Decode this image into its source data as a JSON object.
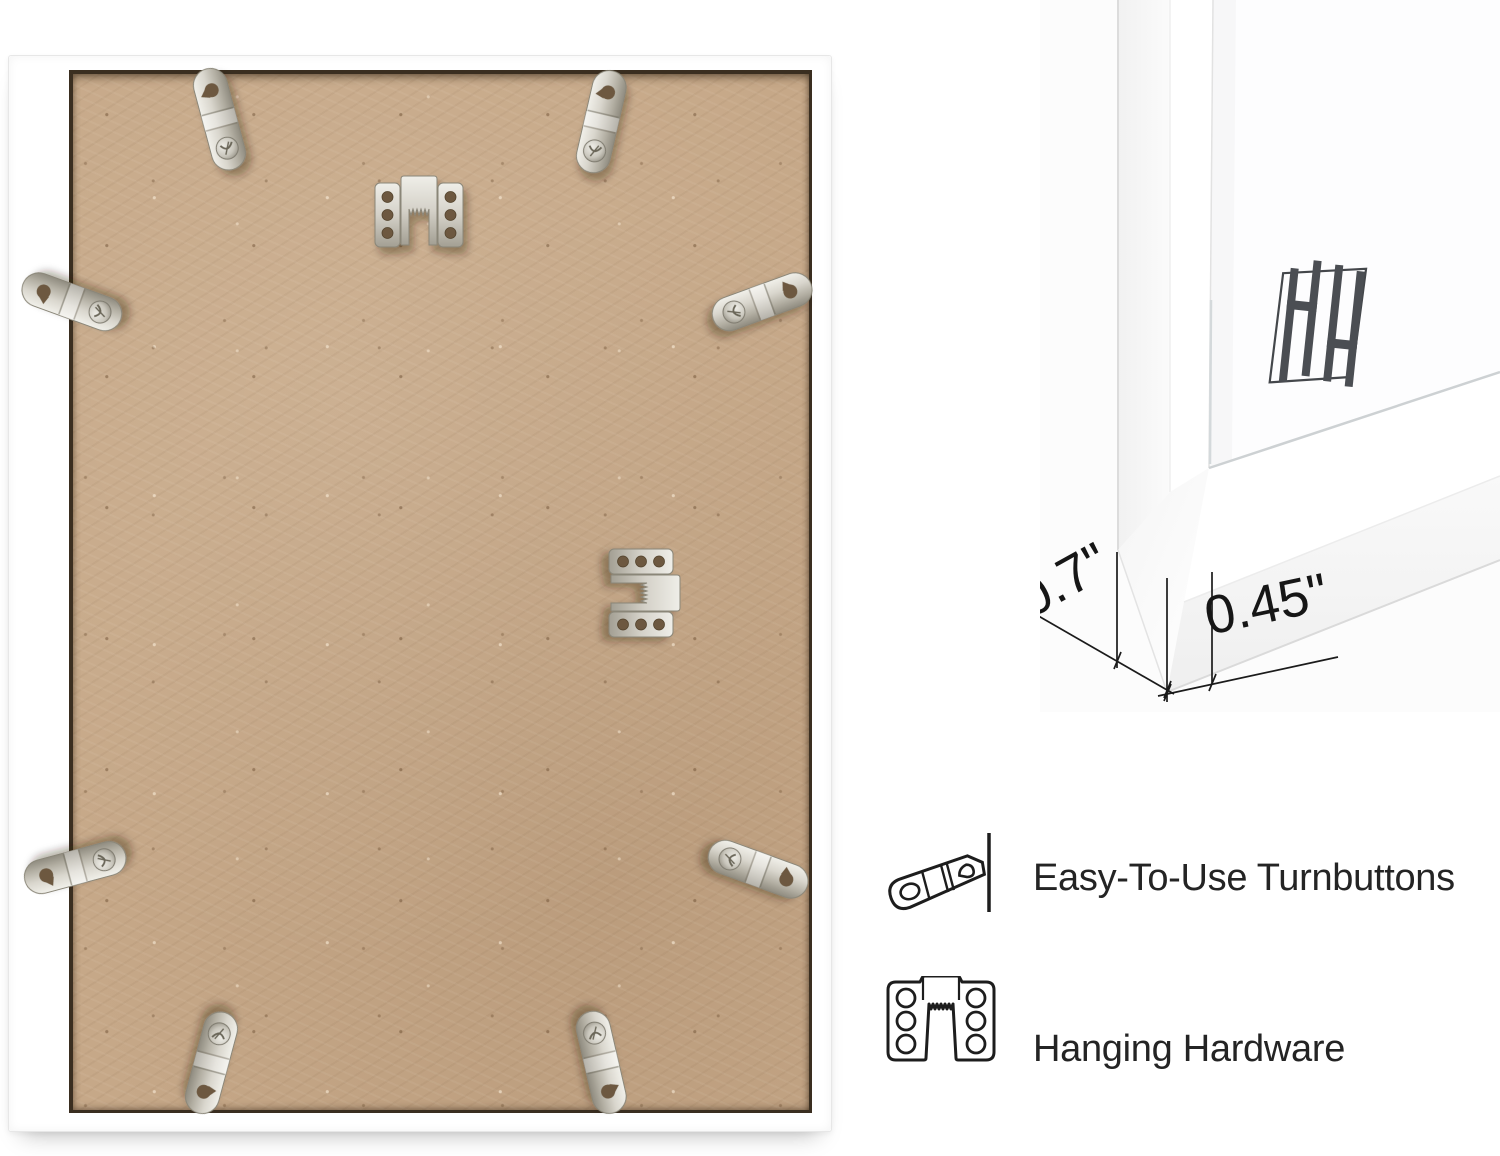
{
  "page": {
    "background": "#ffffff"
  },
  "main_photo": {
    "frame_color": "#ffffff",
    "board_color": "#c6a888",
    "turnbutton_count": 8,
    "sawtooth_hanger_count": 2
  },
  "corner_detail": {
    "logo": "hh-monogram",
    "dimensions": [
      {
        "label": "0.7\""
      },
      {
        "label": "0.45\""
      }
    ]
  },
  "features": [
    {
      "icon": "turnbutton-icon",
      "label": "Easy-To-Use Turnbuttons"
    },
    {
      "icon": "sawtooth-hanger-icon",
      "label": "Hanging Hardware"
    }
  ],
  "colors": {
    "annotation_line": "#1b1b1b",
    "feature_text": "#242424",
    "logo": "#4b4e53",
    "metal_light": "#ecebe6",
    "metal_dark": "#9b978b",
    "seam": "#3a2e20"
  }
}
